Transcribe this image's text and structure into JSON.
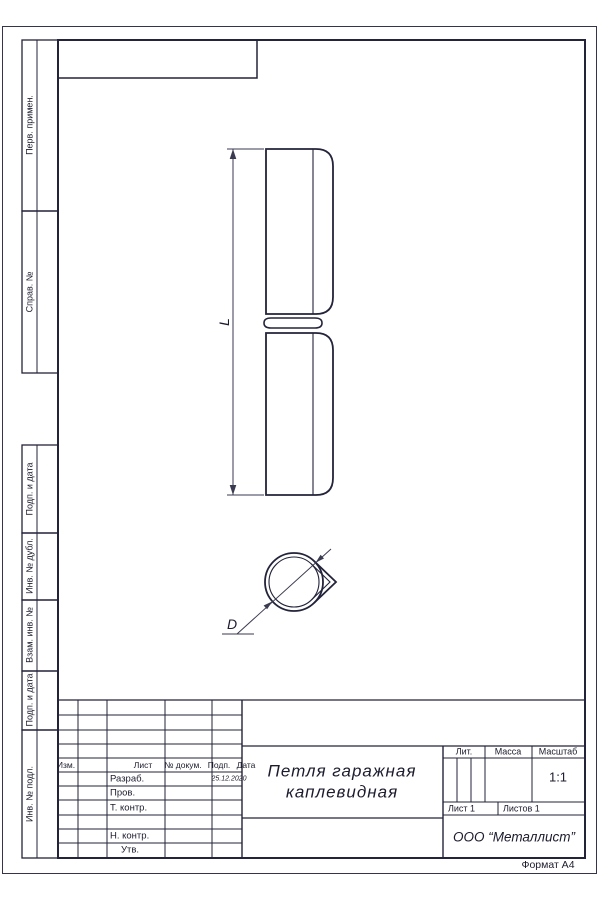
{
  "sheet": {
    "format_note": "Формат А4"
  },
  "sidebar": {
    "first_use": "Перв. примен.",
    "ref_number": "Справ. №",
    "sign_date_1": "Подп. и дата",
    "inv_dupl": "Инв. № дубл.",
    "repl_inv": "Взам. инв. №",
    "sign_date_2": "Подп. и дата",
    "inv_orig": "Инв. № подл."
  },
  "drawing": {
    "length_label": "L",
    "diameter_label": "D"
  },
  "title_block": {
    "header": {
      "izm": "Изм.",
      "list": "Лист",
      "doc_num": "№ докум.",
      "sign": "Подп.",
      "date": "Дата"
    },
    "rows": {
      "developed": "Разраб.",
      "checked": "Пров.",
      "tech_control": "Т. контр.",
      "norm_control": "Н. контр.",
      "approved": "Утв."
    },
    "date_value": "25.12.2020",
    "title_line1": "Петля гаражная",
    "title_line2": "каплевидная",
    "lit": "Лит.",
    "mass": "Масса",
    "scale": "Масштаб",
    "scale_value": "1:1",
    "sheet": "Лист 1",
    "sheets": "Листов 1",
    "company": "ООО “Металлист”"
  }
}
